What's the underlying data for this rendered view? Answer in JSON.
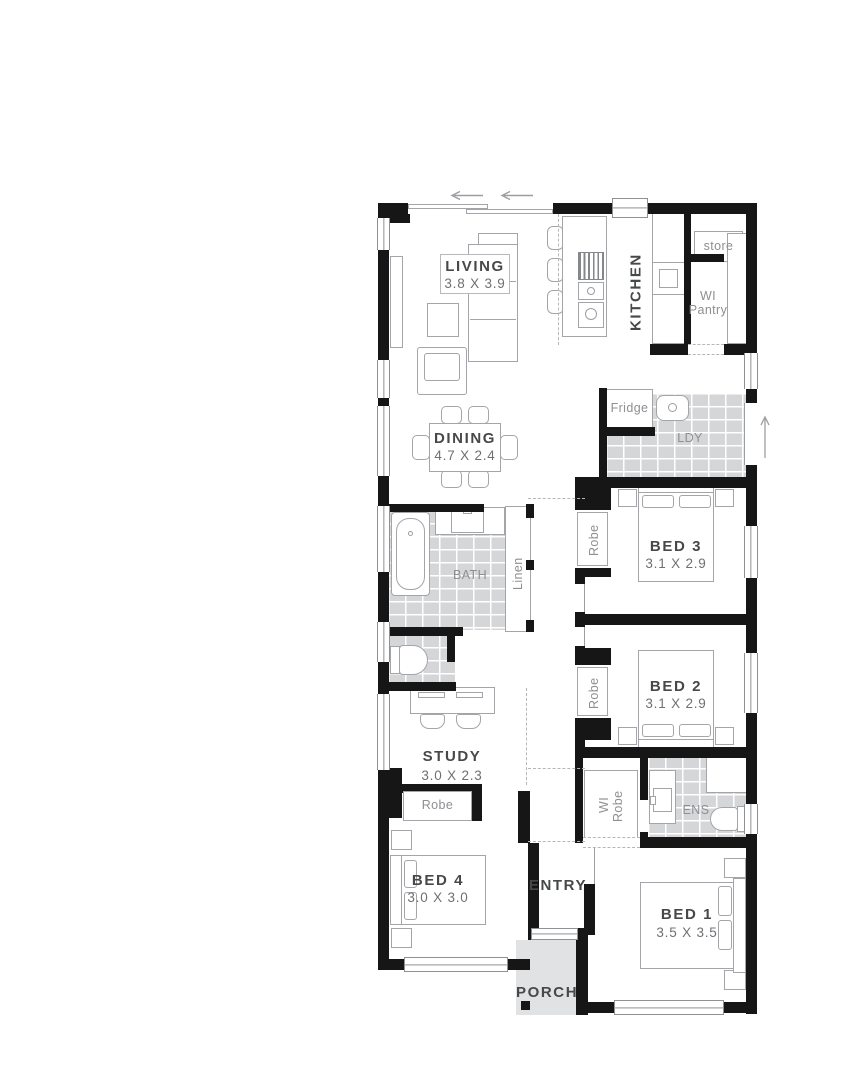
{
  "rooms": {
    "living": {
      "label": "LIVING",
      "dims": "3.8 X 3.9"
    },
    "dining": {
      "label": "DINING",
      "dims": "4.7 X 2.4"
    },
    "kitchen": {
      "label": "KITCHEN"
    },
    "bed1": {
      "label": "BED 1",
      "dims": "3.5 X 3.5"
    },
    "bed2": {
      "label": "BED 2",
      "dims": "3.1 X 2.9"
    },
    "bed3": {
      "label": "BED 3",
      "dims": "3.1 X 2.9"
    },
    "bed4": {
      "label": "BED 4",
      "dims": "3.0 X 3.0"
    },
    "study": {
      "label": "STUDY",
      "dims": "3.0 X 2.3"
    },
    "bath": {
      "label": "BATH"
    },
    "ens": {
      "label": "ENS"
    },
    "laundry": {
      "label": "LDY"
    },
    "entry": {
      "label": "ENTRY"
    },
    "porch": {
      "label": "PORCH"
    }
  },
  "storage": {
    "store": {
      "label": "store"
    },
    "wi_pantry": {
      "line1": "WI",
      "line2": "Pantry"
    },
    "linen": {
      "label": "Linen"
    },
    "robe_bed3": {
      "label": "Robe"
    },
    "robe_bed2": {
      "label": "Robe"
    },
    "robe_bed4": {
      "label": "Robe"
    },
    "wi_robe": {
      "line1": "WI",
      "line2": "Robe"
    }
  },
  "appliances": {
    "fridge": {
      "label": "Fridge"
    }
  },
  "colors": {
    "wall": "#161616",
    "tile_floor": "#d5d6d8",
    "porch_floor": "#e1e2e4",
    "room_label": "#46484a",
    "dim_label": "#6e7073",
    "small_label": "#8d8f92"
  }
}
